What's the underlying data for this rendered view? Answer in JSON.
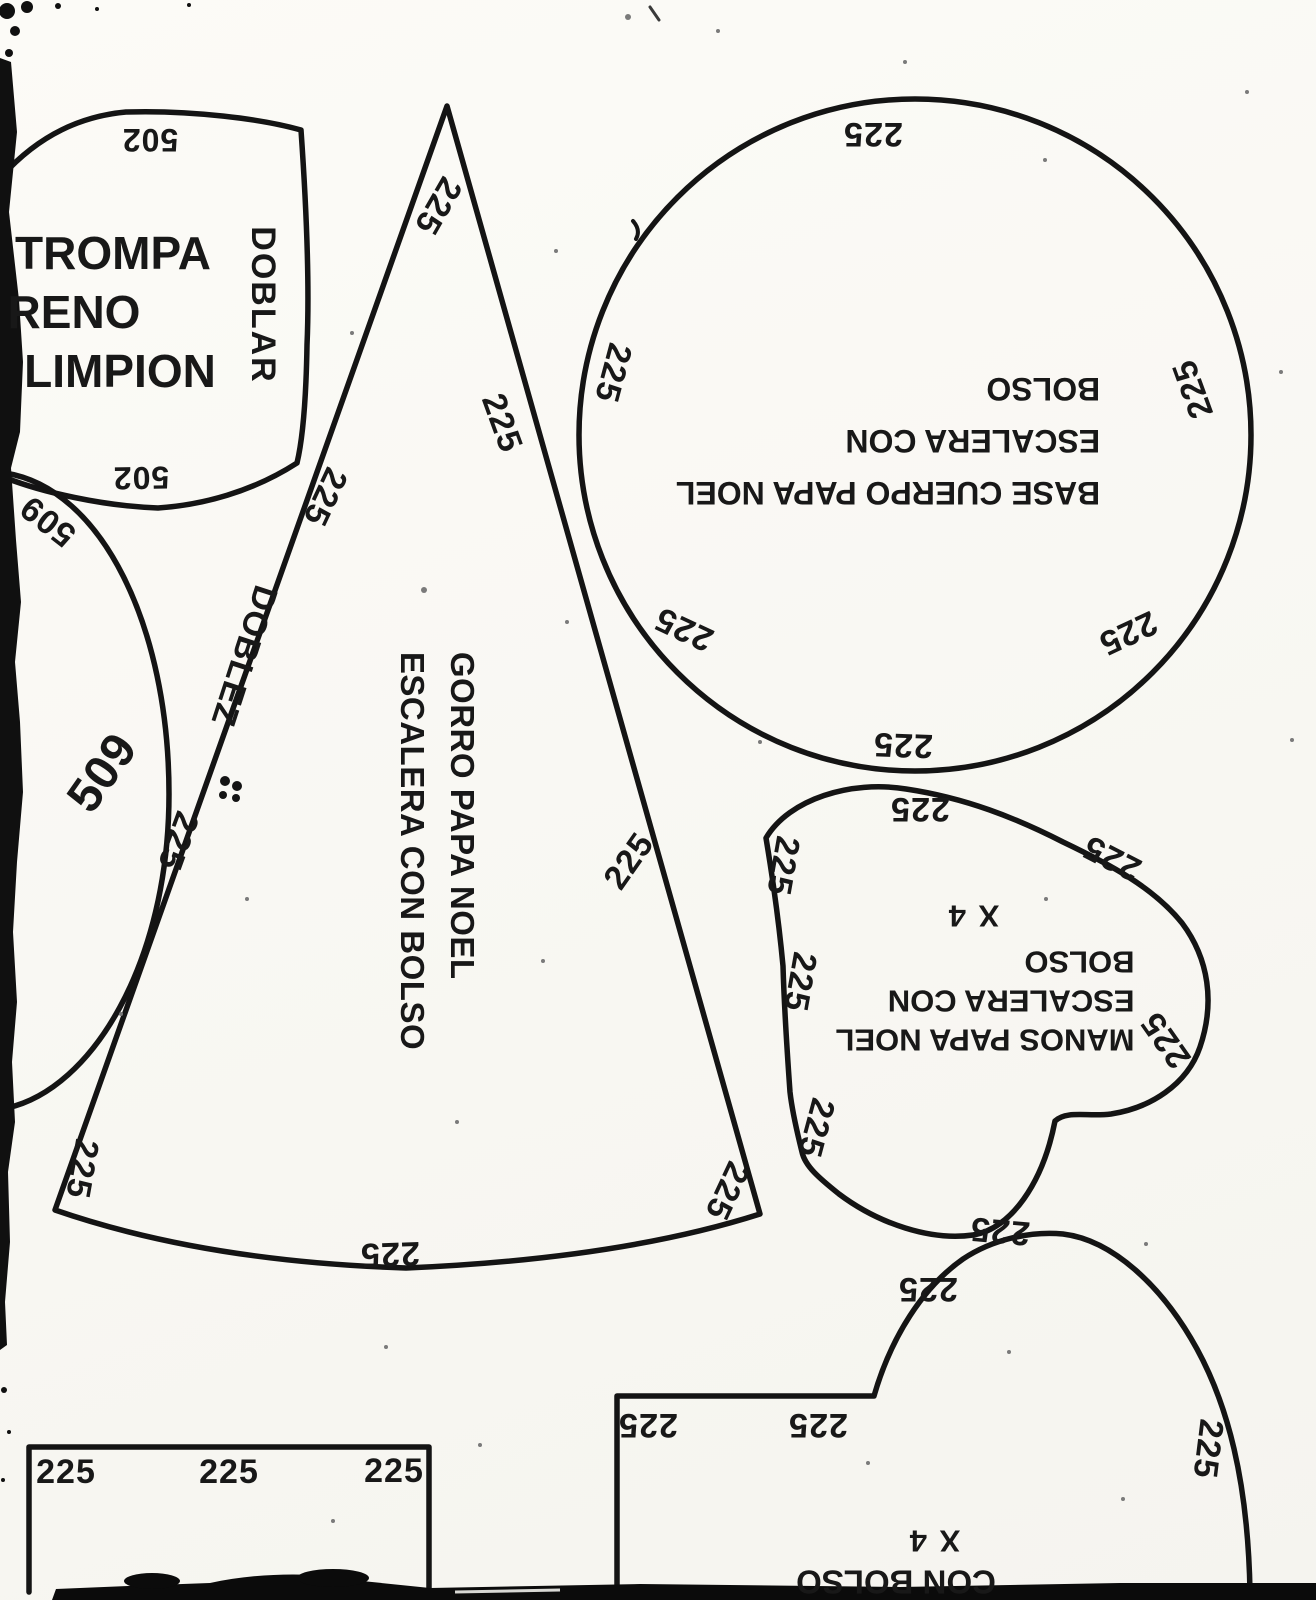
{
  "sheet": {
    "paper_color": "#fbfaf7",
    "ink_color": "#141414"
  },
  "pieces": {
    "trompa": {
      "name_line1": "TROMPA",
      "name_line2": "RENO",
      "name_line3": "LIMPION",
      "fold_label": "DOBLAR",
      "size_top": "502",
      "size_bottom": "502"
    },
    "partial_circle": {
      "size_small": "509",
      "size_large": "509"
    },
    "gorro": {
      "name_line1": "GORRO PAPA NOEL",
      "name_line2": "ESCALERA CON BOLSO",
      "fold_label": "DOBLEZ",
      "sizes": [
        "225",
        "225",
        "225",
        "225",
        "225",
        "225",
        "225",
        "225"
      ]
    },
    "base": {
      "name_line1": "BASE CUERPO PAPA NOEL",
      "name_line2": "ESCALERA CON",
      "name_line3": "BOLSO",
      "sizes": [
        "225",
        "225",
        "225",
        "225",
        "225",
        "225"
      ]
    },
    "manos": {
      "name_line1": "MANOS PAPA NOEL",
      "name_line2": "ESCALERA CON",
      "name_line3": "BOLSO",
      "quantity": "X 4",
      "sizes": [
        "225",
        "225",
        "225",
        "225",
        "225",
        "225",
        "225"
      ]
    },
    "strip": {
      "sizes": [
        "225",
        "225",
        "225"
      ]
    },
    "bottom_piece": {
      "name_partial": "CON BOLSO",
      "quantity": "X 4",
      "sizes": [
        "225",
        "225",
        "225",
        "225"
      ]
    }
  }
}
